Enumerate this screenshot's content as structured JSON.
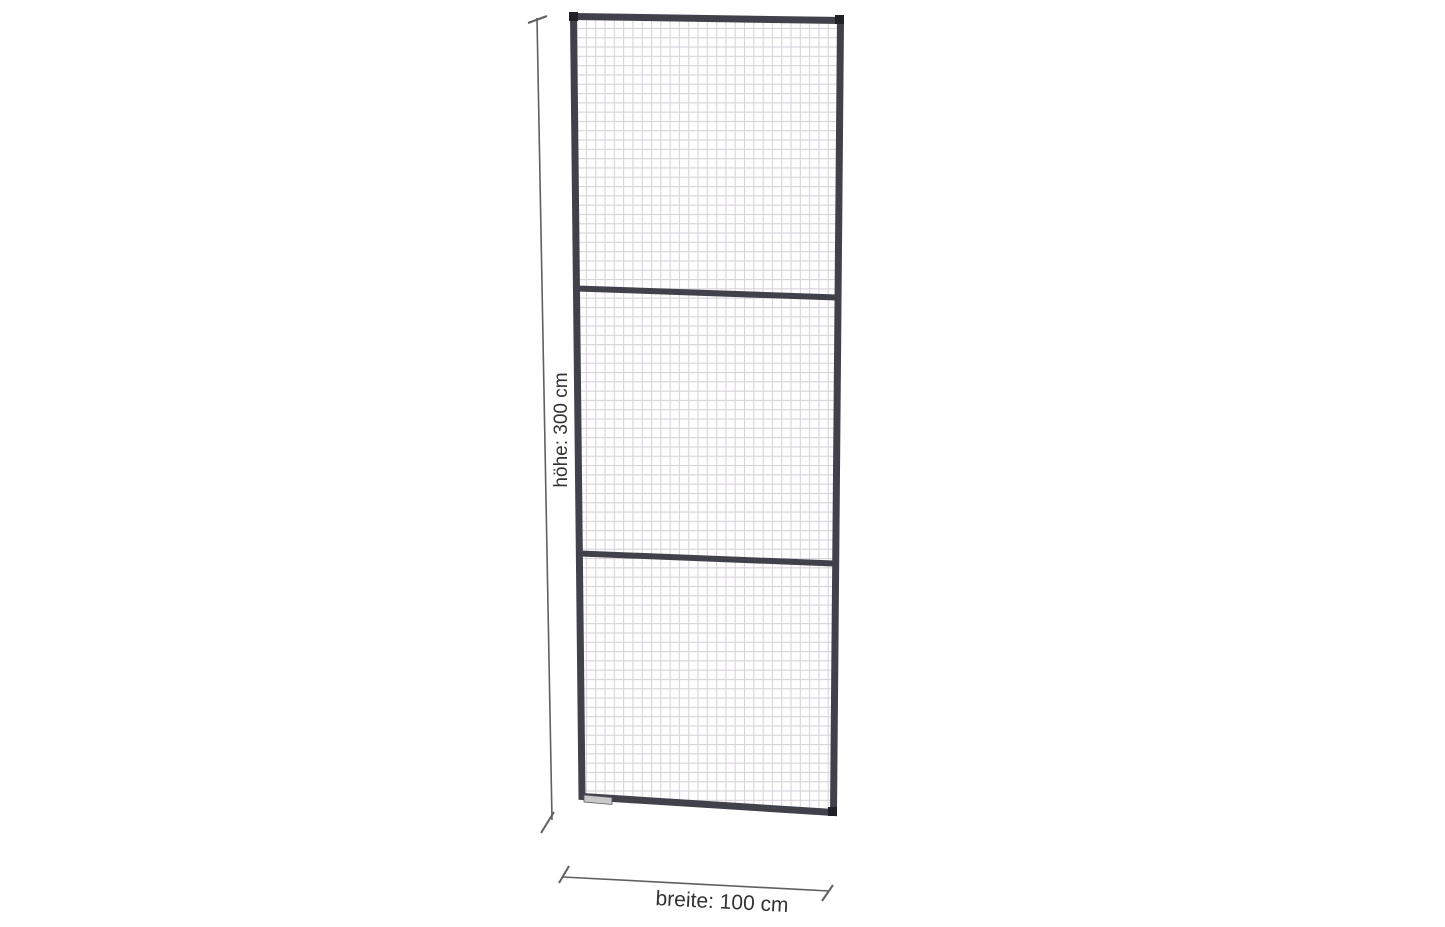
{
  "page": {
    "background_color": "#ffffff"
  },
  "diagram": {
    "height_label": "höhe: 300 cm",
    "width_label": "breite: 100 cm",
    "panel": {
      "section_count": 3,
      "frame_color": "#41414b",
      "corner_cap_color": "#202027",
      "mesh_line_color": "#d7d3d9",
      "mesh_background_color": "#fefefe",
      "foot_plate_fill": "#c9c9c9",
      "foot_plate_stroke": "#55555e"
    },
    "dimensions": {
      "line_color": "#606060",
      "label_color": "#333333"
    }
  }
}
